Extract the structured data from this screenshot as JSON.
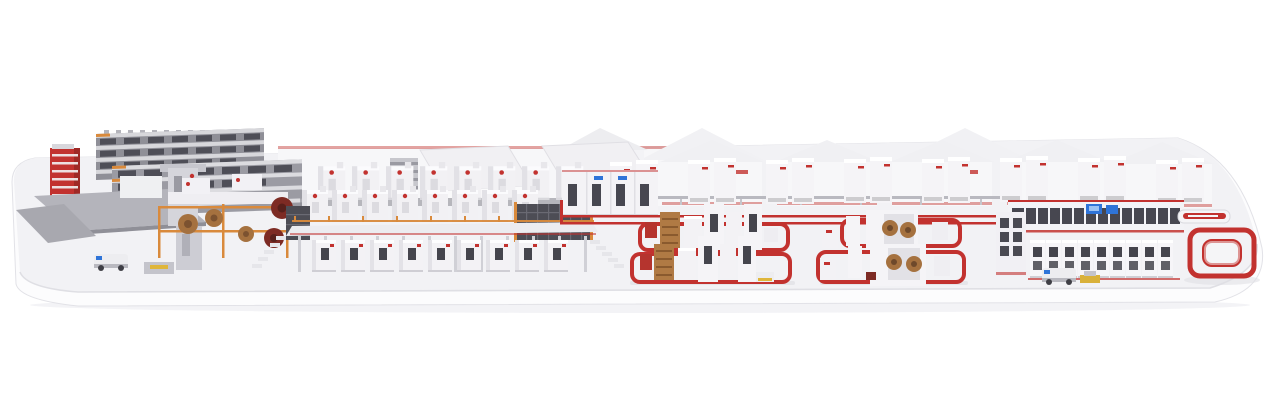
{
  "scene": {
    "description": "isometric 3d render of a complete corrugated-board production plant on a rounded white platform",
    "parts": [
      "roll-storage-racks",
      "red-roll-elevator",
      "loading-ramp",
      "agv-vehicle",
      "splicer-roll-stands",
      "corrugator-bridge",
      "canopy-roofs",
      "factory-buildings",
      "dry-end-cabinets",
      "floor-conveyor-network",
      "converting-line-1",
      "converting-line-2",
      "logistics-gallery",
      "palletizing-cabinets",
      "red-loop-conveyor"
    ]
  },
  "palette": {
    "background": "#ffffff",
    "platform_top": "#f2f2f5",
    "platform_face": "#fcfcfd",
    "platform_edge": "#d9d9de",
    "shadow": "#e5e5ea",
    "machine_white": "#f3f2f5",
    "machine_shade": "#e2e1e6",
    "accent_red": "#c2322f",
    "deep_red": "#a32824",
    "orange": "#d98a3c",
    "paper_brown": "#a5713f",
    "roll_maroon": "#7d2b24",
    "rack_gray": "#8f8f97",
    "rack_dark": "#4e4e57",
    "window_dark": "#45454d",
    "screen_blue": "#2f74d8",
    "steel_gray": "#b7b7be",
    "safety_yellow": "#dfb63b"
  }
}
